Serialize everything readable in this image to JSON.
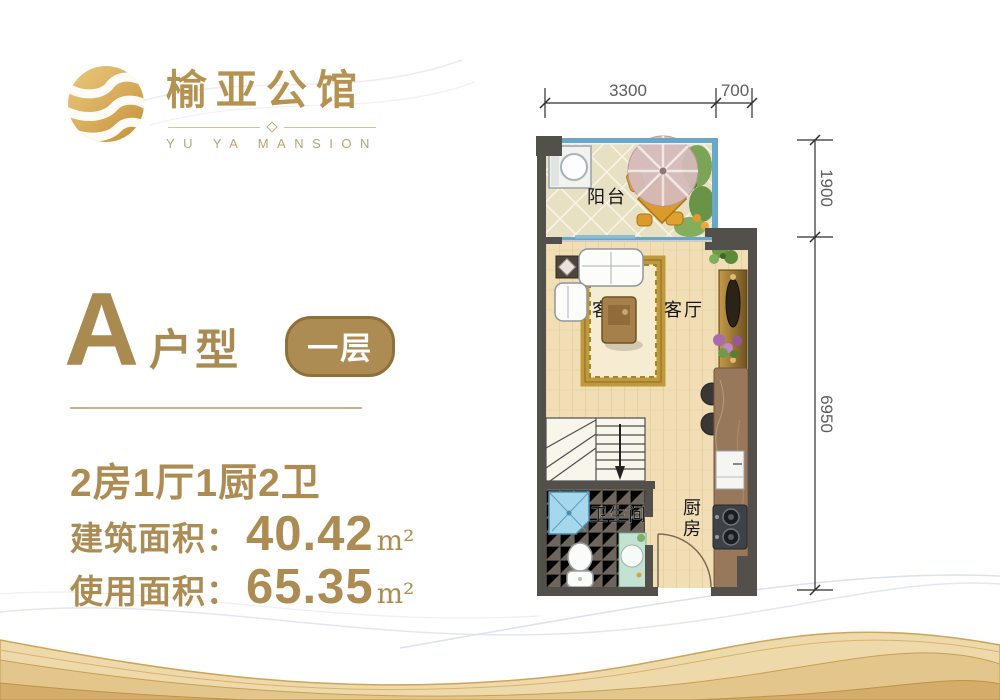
{
  "brand": {
    "name_cn": "榆亚公馆",
    "name_en": "YU YA MANSION"
  },
  "unit": {
    "letter": "A",
    "type_label": "户型",
    "floor_badge": "一层",
    "rooms_summary": "2房1厅1厨2卫",
    "areas": [
      {
        "label": "建筑面积：",
        "value": "40.42",
        "unit": "m²"
      },
      {
        "label": "使用面积：",
        "value": "65.35",
        "unit": "m²"
      }
    ]
  },
  "floorplan": {
    "labels": {
      "balcony": "阳台",
      "living_room": "客厅",
      "living_partial": "客",
      "bathroom": "卫生间",
      "kitchen": "厨房"
    },
    "dimensions": {
      "top": [
        {
          "value": "3300"
        },
        {
          "value": "700"
        }
      ],
      "right": [
        {
          "value": "1900"
        },
        {
          "value": "6950"
        }
      ]
    }
  },
  "colors": {
    "gold_text": "#ad8c54",
    "badge_bg": "#ad8c54",
    "wall": "#53504b",
    "glass": "#6aa6c6",
    "wave_gold": "#e2c68c"
  }
}
